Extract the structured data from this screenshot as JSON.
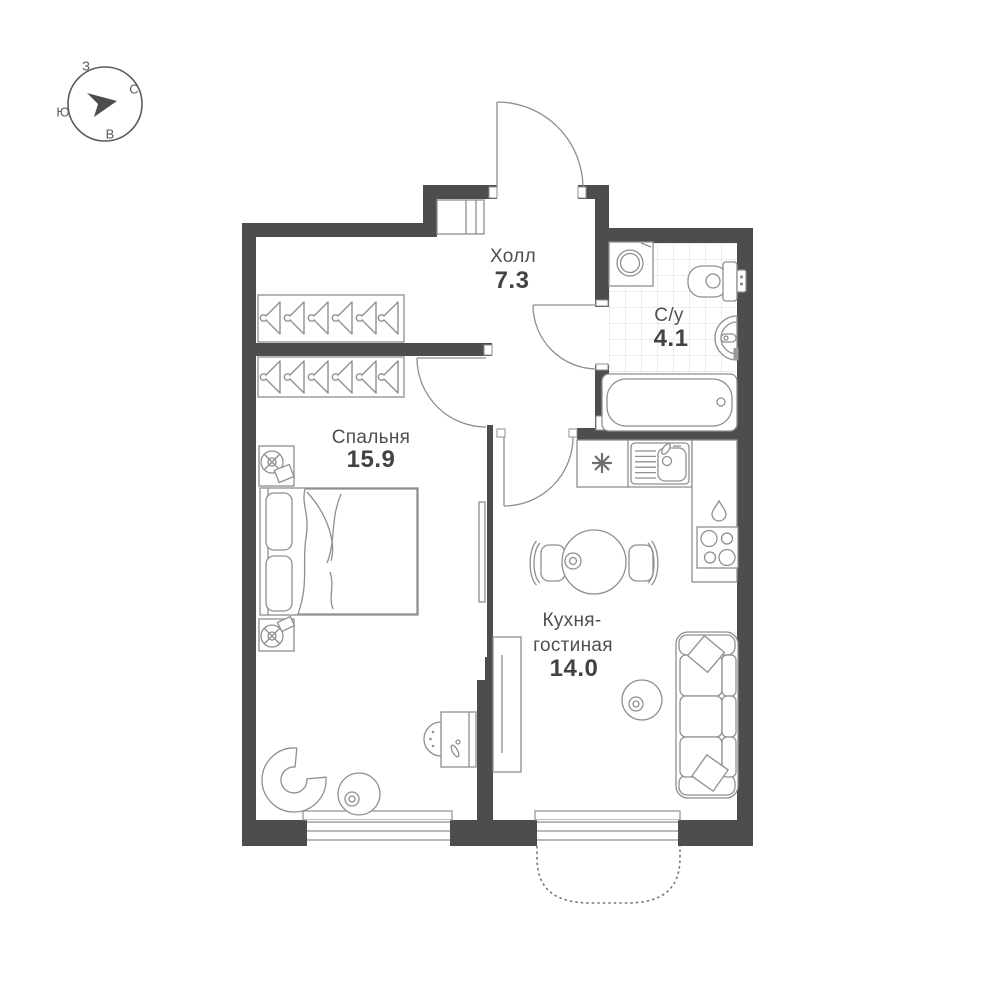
{
  "title": "1-room apartment floor plan",
  "compass": {
    "north": "С",
    "south": "Ю",
    "west": "З",
    "east": "В"
  },
  "rooms": {
    "hall": {
      "name": "Холл",
      "area": "7.3"
    },
    "bathroom": {
      "name": "С/у",
      "area": "4.1"
    },
    "bedroom": {
      "name": "Спальня",
      "area": "15.9"
    },
    "kitchen_living": {
      "name_line1": "Кухня-",
      "name_line2": "гостиная",
      "area": "14.0"
    }
  },
  "icons": {
    "compass_needle": "compass-needle-icon",
    "ventilation": "vent-asterisk-icon",
    "water_inlet": "water-drop-icon",
    "stove": "stove-4-burner-icon",
    "hanger": "coat-hanger-icon",
    "lamp": "lamp-icon"
  },
  "colors": {
    "wall": "#4d4d4d",
    "furniture_stroke": "#8f8f8f",
    "tile_line": "#e2e2e2",
    "text": "#4f4f4f"
  }
}
